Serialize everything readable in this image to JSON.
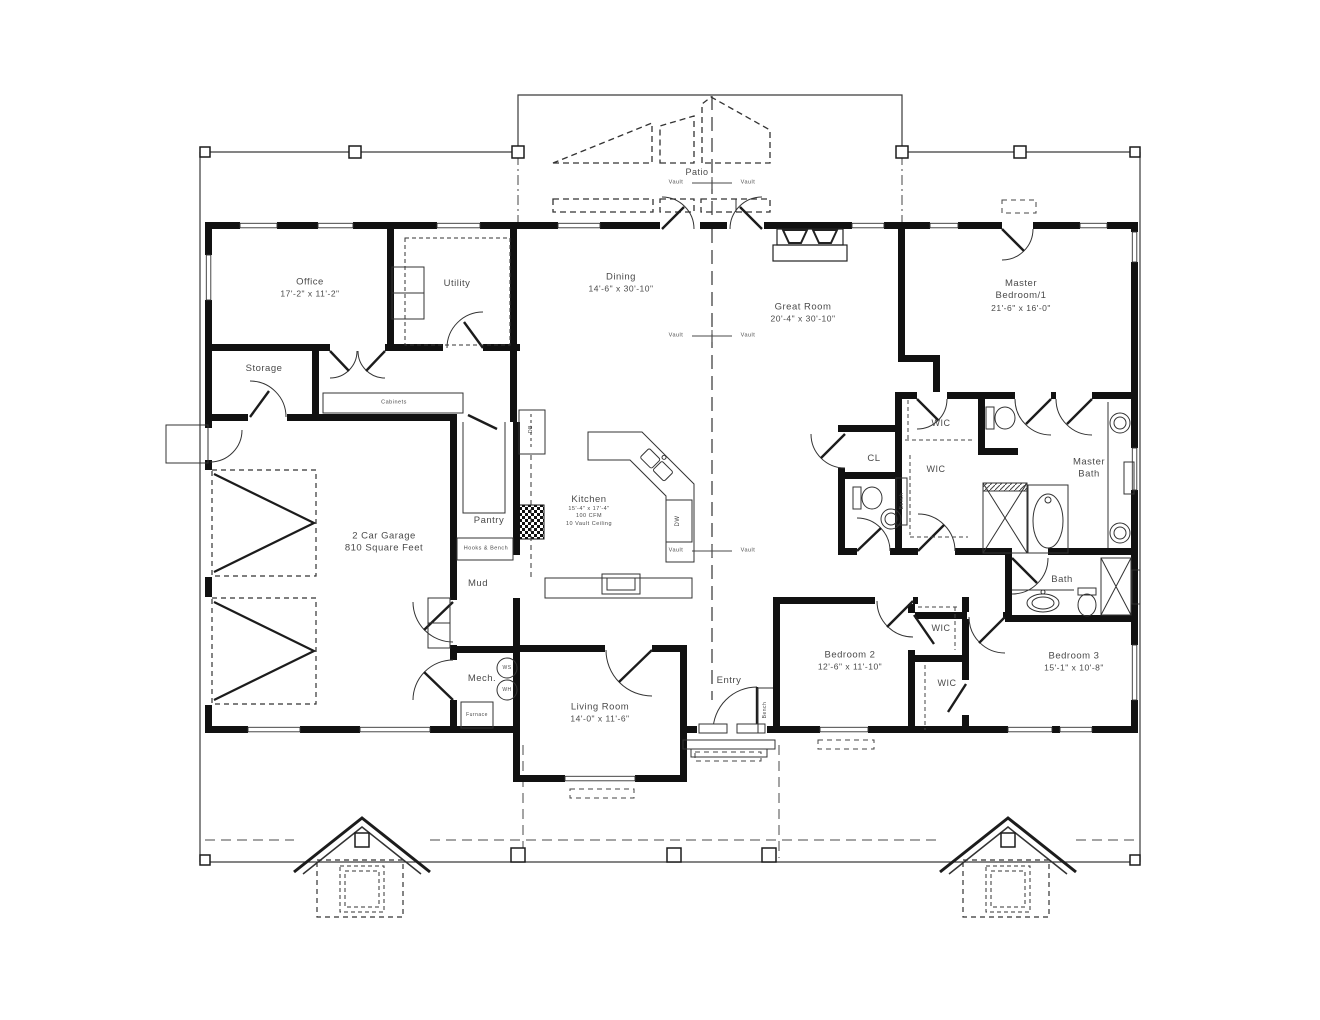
{
  "document": {
    "type": "architectural-floor-plan"
  },
  "colors": {
    "wall": "#111111",
    "thin_line": "#3a3a3a",
    "dashed_line": "#4a4a4a",
    "text": "#4a4a4a",
    "background": "#ffffff"
  },
  "plan": {
    "rooms": [
      {
        "id": "office",
        "x": 310,
        "y": 288,
        "lines": [
          "Office",
          "17'-2\" x 11'-2\""
        ]
      },
      {
        "id": "utility",
        "x": 457,
        "y": 284,
        "lines": [
          "Utility"
        ]
      },
      {
        "id": "storage",
        "x": 264,
        "y": 369,
        "lines": [
          "Storage"
        ]
      },
      {
        "id": "dining",
        "x": 621,
        "y": 283,
        "lines": [
          "Dining",
          "14'-6\" x 30'-10\""
        ]
      },
      {
        "id": "great-room",
        "x": 803,
        "y": 313,
        "lines": [
          "Great Room",
          "20'-4\" x 30'-10\""
        ]
      },
      {
        "id": "master-bedroom",
        "x": 1021,
        "y": 296,
        "lines": [
          "Master",
          "Bedroom/1",
          "21'-6\" x 16'-0\""
        ],
        "sizes": [
          9.5,
          9.5,
          8.5
        ]
      },
      {
        "id": "garage",
        "x": 384,
        "y": 543,
        "lines": [
          "2 Car Garage",
          "810 Square Feet"
        ],
        "sizes": [
          9.5,
          9.5
        ]
      },
      {
        "id": "pantry",
        "x": 489,
        "y": 521,
        "lines": [
          "Pantry"
        ]
      },
      {
        "id": "kitchen",
        "x": 589,
        "y": 511,
        "lines": [
          "Kitchen",
          "15'-4\" x 17'-4\"",
          "100 CFM",
          "10 Vault Ceiling"
        ],
        "sizes": [
          9.5,
          5.5,
          5.5,
          5.5
        ]
      },
      {
        "id": "mud",
        "x": 478,
        "y": 584,
        "lines": [
          "Mud"
        ]
      },
      {
        "id": "mech",
        "x": 482,
        "y": 679,
        "lines": [
          "Mech."
        ]
      },
      {
        "id": "living-room",
        "x": 600,
        "y": 713,
        "lines": [
          "Living Room",
          "14'-0\" x 11'-6\""
        ]
      },
      {
        "id": "entry",
        "x": 729,
        "y": 681,
        "lines": [
          "Entry"
        ]
      },
      {
        "id": "bedroom-2",
        "x": 850,
        "y": 661,
        "lines": [
          "Bedroom 2",
          "12'-6\" x 11'-10\""
        ]
      },
      {
        "id": "bedroom-3",
        "x": 1074,
        "y": 662,
        "lines": [
          "Bedroom 3",
          "15'-1\" x 10'-8\""
        ]
      },
      {
        "id": "wic-master-upper",
        "x": 941,
        "y": 424,
        "lines": [
          "WIC"
        ],
        "sizes": [
          9
        ]
      },
      {
        "id": "wic-master-lower",
        "x": 936,
        "y": 470,
        "lines": [
          "WIC"
        ],
        "sizes": [
          9
        ]
      },
      {
        "id": "wic-bedroom2-upper",
        "x": 941,
        "y": 629,
        "lines": [
          "WIC"
        ],
        "sizes": [
          9
        ]
      },
      {
        "id": "wic-bedroom2-lower",
        "x": 947,
        "y": 684,
        "lines": [
          "WIC"
        ],
        "sizes": [
          9
        ]
      },
      {
        "id": "closet-cl",
        "x": 874,
        "y": 459,
        "lines": [
          "CL"
        ]
      },
      {
        "id": "master-bath",
        "x": 1089,
        "y": 469,
        "lines": [
          "Master",
          "Bath"
        ],
        "sizes": [
          9.5,
          9.5
        ]
      },
      {
        "id": "bath",
        "x": 1062,
        "y": 580,
        "lines": [
          "Bath"
        ]
      }
    ],
    "annotations": [
      {
        "text": "Patio",
        "x": 697,
        "y": 173,
        "size": 9
      },
      {
        "text": "Vault",
        "x": 676,
        "y": 183,
        "size": 5.5
      },
      {
        "text": "Vault",
        "x": 748,
        "y": 183,
        "size": 5.5
      },
      {
        "text": "Vault",
        "x": 676,
        "y": 336,
        "size": 5.5
      },
      {
        "text": "Vault",
        "x": 748,
        "y": 336,
        "size": 5.5
      },
      {
        "text": "Vault",
        "x": 676,
        "y": 551,
        "size": 5.5
      },
      {
        "text": "Vault",
        "x": 748,
        "y": 551,
        "size": 5.5
      },
      {
        "text": "Cabinets",
        "x": 394,
        "y": 403,
        "size": 5.5
      },
      {
        "text": "Hooks & Bench",
        "x": 486,
        "y": 549,
        "size": 5.5
      },
      {
        "text": "DB",
        "x": 531,
        "y": 429,
        "size": 5,
        "rot": true
      },
      {
        "text": "DW",
        "x": 679,
        "y": 521,
        "size": 6,
        "rot": true
      },
      {
        "text": "WS",
        "x": 507,
        "y": 668,
        "size": 5
      },
      {
        "text": "WH",
        "x": 507,
        "y": 690,
        "size": 5
      },
      {
        "text": "Furnace",
        "x": 477,
        "y": 715,
        "size": 5
      },
      {
        "text": "Bench",
        "x": 902,
        "y": 501,
        "size": 5,
        "rot": true
      },
      {
        "text": "Bench",
        "x": 765,
        "y": 710,
        "size": 5,
        "rot": true
      }
    ]
  }
}
